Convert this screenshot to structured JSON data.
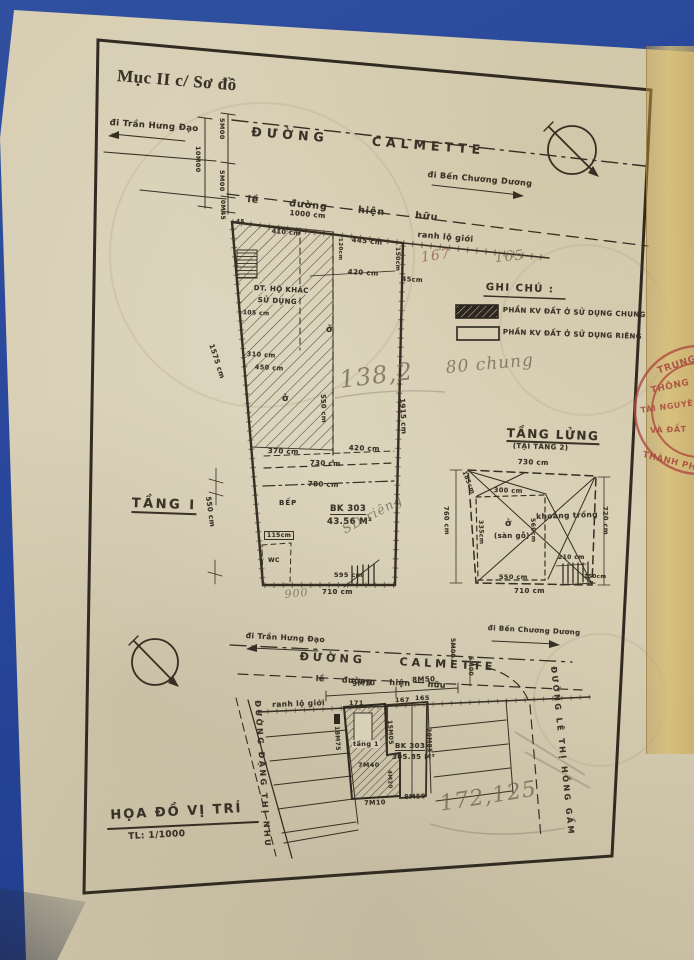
{
  "doc": {
    "section_title": "Mục II c/ Sơ đồ"
  },
  "top_plan": {
    "street": "ĐƯỜNG CALMETTE",
    "dir_left": "đi Trần Hưng Đạo",
    "dir_right": "đi Bến Chương Dương",
    "sidewalk": "lề đường hiện hữu",
    "dims": {
      "total": "10M00",
      "half_a": "5M00",
      "half_b": "5M00",
      "offset": "0M45"
    }
  },
  "floor1": {
    "title": "TẦNG I",
    "boundary": "ranh lộ giới",
    "other_use_1": "DT. HỘ KHÁC",
    "other_use_2": "SỬ DỤNG",
    "kitchen": "BẾP",
    "wc": "WC",
    "room_a": "ở",
    "room_b": "ở",
    "unit_code": "BK 303",
    "unit_area": "43.56 M²",
    "dims": {
      "top": "1000 cm",
      "seg_a": "410 cm",
      "corner": "45",
      "seg_b": "445 cm",
      "edge_r": "150cm",
      "edge_s": "120cm",
      "mid_a": "420 cm",
      "mid_b": "45cm",
      "room_w": "105 cm",
      "in_a": "310 cm",
      "in_b": "450 cm",
      "in_v": "550 cm",
      "right": "1915 cm",
      "left_up": "1575 cm",
      "left_low": "550 cm",
      "low_a": "370 cm",
      "low_b": "420 cm",
      "low_c": "730 cm",
      "low_d": "780 cm",
      "wc_w": "115cm",
      "bot_a": "595 cm",
      "bot_b": "710 cm"
    }
  },
  "legend": {
    "title": "GHI CHÚ :",
    "common": "PHẦN KV ĐẤT Ở SỬ DỤNG CHUNG",
    "private": "PHẦN KV ĐẤT Ở SỬ DỤNG RIÊNG"
  },
  "mezzanine": {
    "title": "TẦNG LỬNG",
    "subtitle": "(TẠI TẦNG 2)",
    "room": "ở",
    "room_note": "(sàn gỗ)",
    "void": "khoảng trống",
    "dims": {
      "top": "730 cm",
      "slant": "185cm",
      "in_top": "300 cm",
      "left": "760 cm",
      "room_h": "335cm",
      "room_w": "560cm",
      "right": "720 cm",
      "stair": "210 cm",
      "bot_a": "550 cm",
      "bot_b": "150cm",
      "bot_c": "710 cm"
    }
  },
  "site_map": {
    "title": "HỌA ĐỒ VỊ TRÍ",
    "scale": "TL: 1/1000",
    "street": "ĐƯỜNG CALMETTE",
    "dir_left": "đi Trần Hưng Đạo",
    "dir_right": "đi Bến Chương Dương",
    "sidewalk": "lề đường hiện hữu",
    "boundary": "ranh lộ giới",
    "street_left": "ĐƯỜNG ĐẶNG THỊ NHU",
    "street_right": "ĐƯỜNG LÊ THỊ HỒNG GẤM",
    "floor_label": "tầng 1",
    "unit_code": "BK 303",
    "unit_area": "305.85 M²",
    "plots": [
      "171",
      "167",
      "165"
    ],
    "dims": {
      "a": "9M70",
      "b": "8M50",
      "c": "5M00",
      "d": "5M00",
      "e": "18M75",
      "f": "15M05",
      "g": "7M40",
      "h": "20M85",
      "i": "4M20",
      "j": "7M10",
      "k": "8M50"
    }
  },
  "pencil": {
    "n167": "167",
    "n165": "165",
    "n138": "138,2",
    "chung": "80 chung",
    "rieng": "SD riêng",
    "n900": "900",
    "n172": "172,125"
  },
  "stamp": {
    "l1": "TRUNG",
    "l2": "THÔNG",
    "l3": "TÀI NGUYÊN",
    "l4": "VÀ ĐẤT",
    "l5": "THÀNH PH"
  },
  "colors": {
    "paper": "#d7cfb6",
    "ink": "#372f23",
    "stamp": "#b04a3e",
    "background": "#2b4a9c",
    "tape": "#d0b472"
  }
}
